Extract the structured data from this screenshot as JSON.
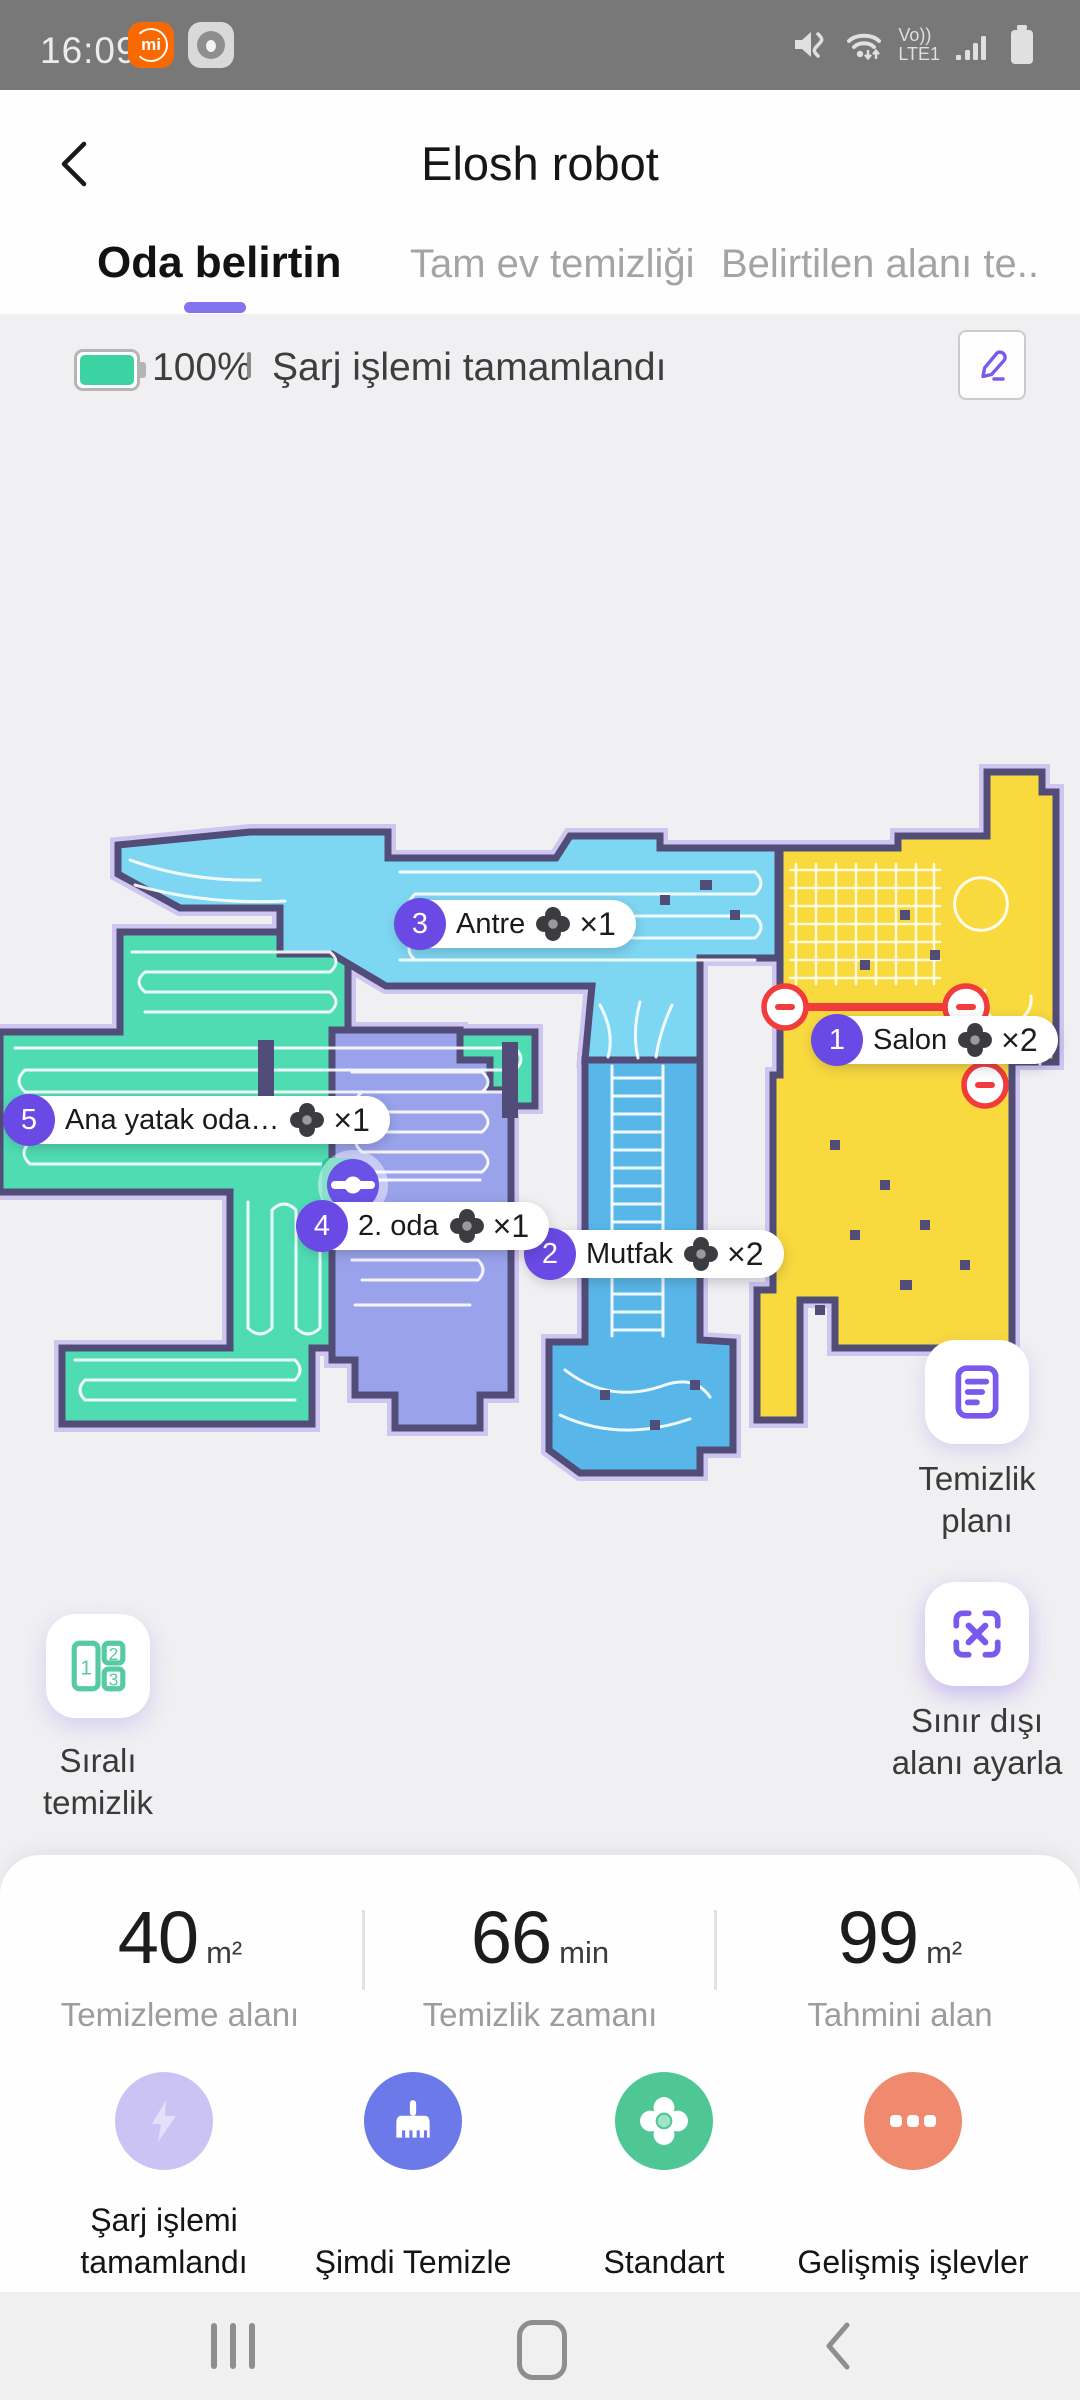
{
  "status_bar": {
    "time": "16:09",
    "mi_logo": "mi",
    "volte_line1": "Vo))",
    "volte_line2": "LTE1"
  },
  "header": {
    "title": "Elosh robot"
  },
  "tabs": [
    {
      "label": "Oda belirtin",
      "active": true
    },
    {
      "label": "Tam ev temizliği",
      "active": false
    },
    {
      "label": "Belirtilen alanı te..",
      "active": false
    }
  ],
  "robot_status": {
    "battery_percent": "100%",
    "message": "Şarj işlemi tamamlandı"
  },
  "map": {
    "rooms": [
      {
        "num": "1",
        "name": "Salon",
        "count": "×2"
      },
      {
        "num": "2",
        "name": "Mutfak",
        "count": "×2"
      },
      {
        "num": "3",
        "name": "Antre",
        "count": "×1"
      },
      {
        "num": "4",
        "name": "2. oda",
        "count": "×1"
      },
      {
        "num": "5",
        "name": "Ana yatak oda…",
        "count": "×1"
      }
    ],
    "colors": {
      "salon": "#F8D93E",
      "mutfak": "#58B7E8",
      "antre": "#7ED7F2",
      "oda2": "#9AA2EC",
      "ana_yatak": "#4FDCB3",
      "wall": "#514D78",
      "fringe": "#CBC1F0",
      "virtual_wall": "#F23B3B",
      "track": "#FFFFFF",
      "accent": "#6A49E4"
    }
  },
  "side_buttons": {
    "cleaning_plan": "Temizlik planı",
    "no_go_zone": "Sınır dışı alanı ayarla",
    "sequential": "Sıralı temizlik",
    "sequential_numbers": [
      "1",
      "2",
      "3"
    ]
  },
  "stats": [
    {
      "value": "40",
      "unit": "m²",
      "label": "Temizleme alanı"
    },
    {
      "value": "66",
      "unit": "min",
      "label": "Temizlik zamanı"
    },
    {
      "value": "99",
      "unit": "m²",
      "label": "Tahmini alan"
    }
  ],
  "actions": [
    {
      "label": "Şarj işlemi tamamlandı"
    },
    {
      "label": "Şimdi Temizle"
    },
    {
      "label": "Standart"
    },
    {
      "label": "Gelişmiş işlevler"
    }
  ]
}
